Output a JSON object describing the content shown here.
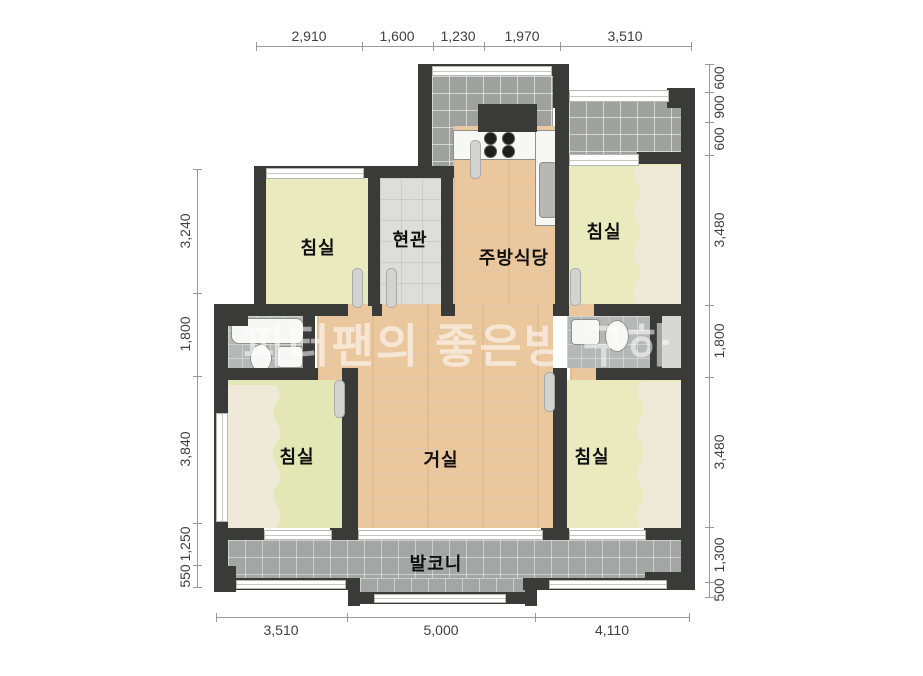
{
  "title": "apartment-floor-plan",
  "watermark": "피터팬의 좋은방 구하",
  "rooms": [
    {
      "id": "bedroom-top-left",
      "label": "침실"
    },
    {
      "id": "entrance",
      "label": "현관"
    },
    {
      "id": "kitchen-dining",
      "label": "주방식당"
    },
    {
      "id": "bedroom-top-right",
      "label": "침실"
    },
    {
      "id": "bedroom-bottom-left",
      "label": "침실"
    },
    {
      "id": "living-room",
      "label": "거실"
    },
    {
      "id": "bedroom-bottom-right",
      "label": "침실"
    },
    {
      "id": "balcony",
      "label": "발코니"
    }
  ],
  "dimensions": {
    "top": [
      "2,910",
      "1,600",
      "1,230",
      "1,970",
      "3,510"
    ],
    "bottom": [
      "3,510",
      "5,000",
      "4,110"
    ],
    "left": [
      "3,240",
      "1,800",
      "3,840",
      "1,250",
      "550"
    ],
    "right": [
      "600",
      "900",
      "600",
      "3,480",
      "1,800",
      "3,480",
      "1,300",
      "500"
    ]
  },
  "colors": {
    "wall": "#3a3a38",
    "wood_floor": "#ebc79d",
    "bedroom_floor": "#e9ebbe",
    "entrance_tile": "#dddddb",
    "balcony_tile": "#a4a6a5",
    "utility_tile": "#9fa19e",
    "closet": "#efe9d8",
    "watermark_white": "#ffffff"
  }
}
